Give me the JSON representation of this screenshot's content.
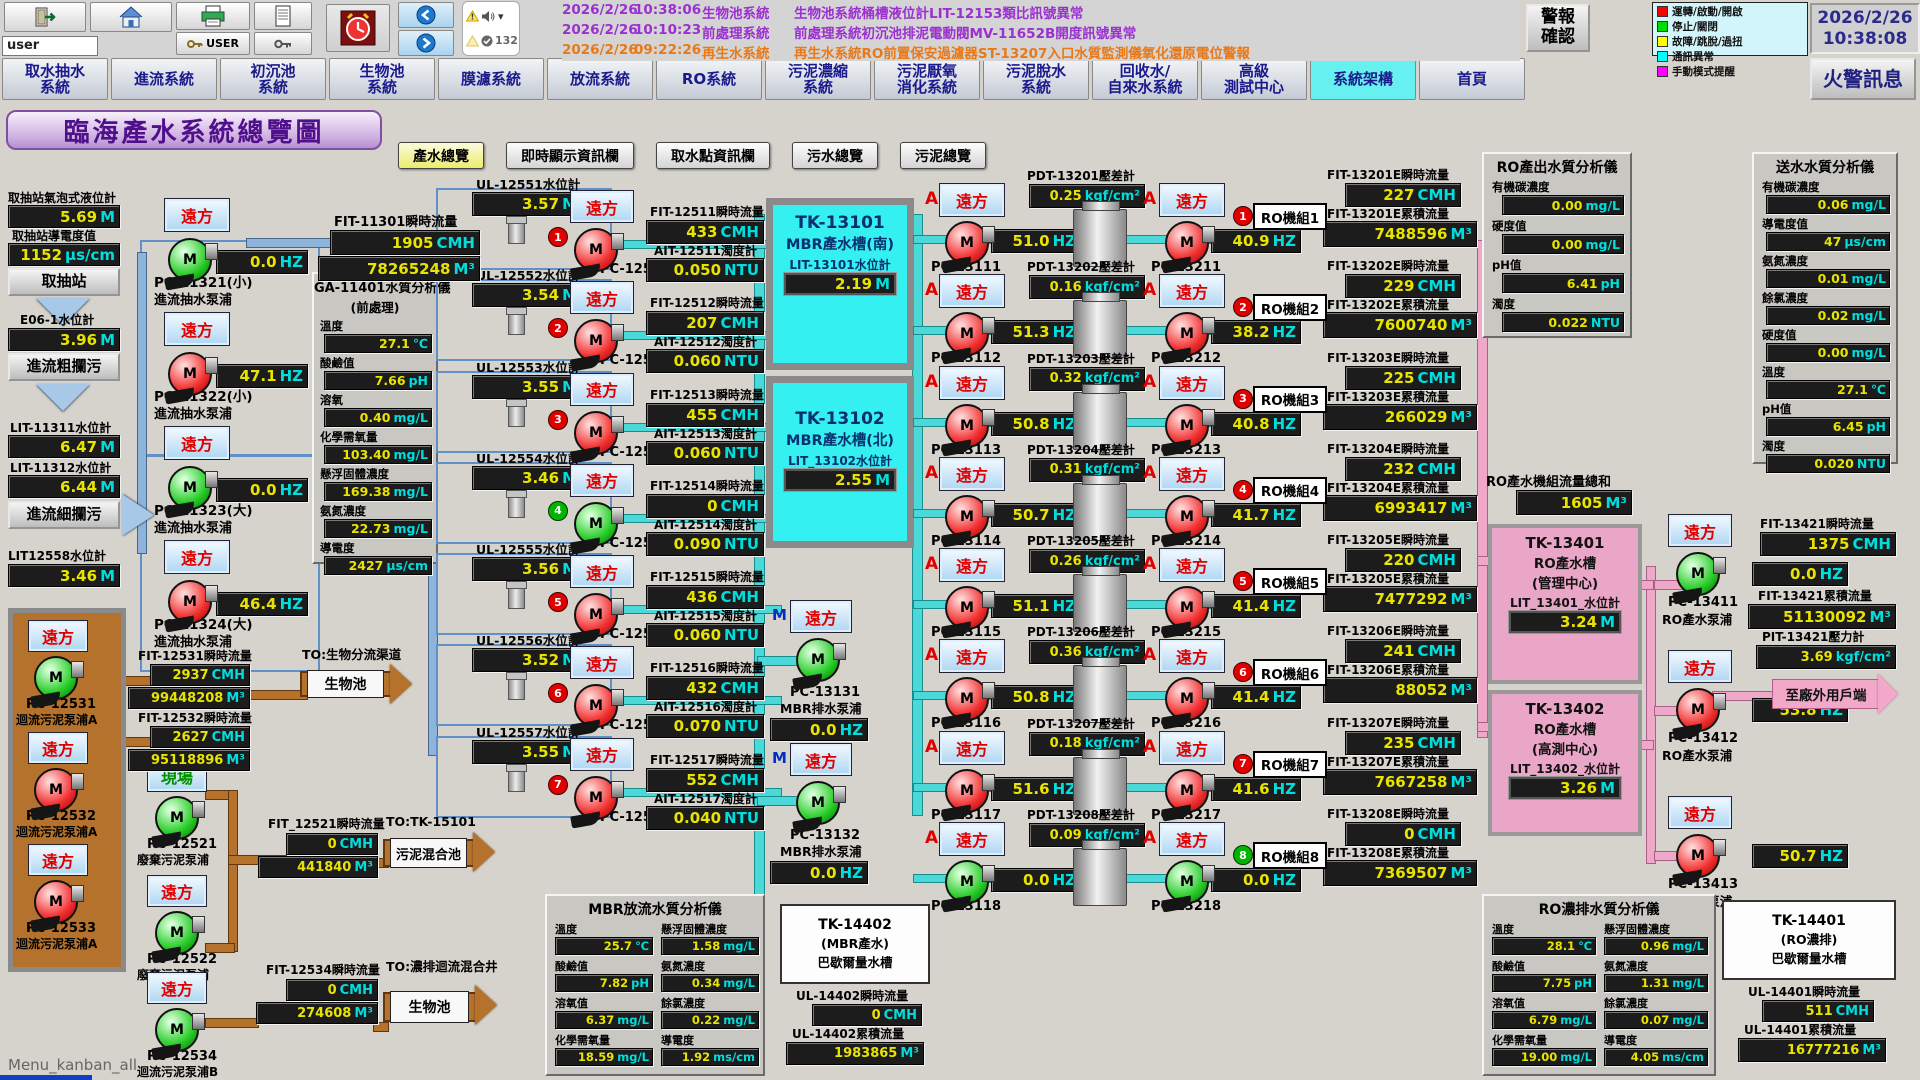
{
  "window": {
    "footer": "Menu_kanban_all"
  },
  "toolbar": {
    "user_value": "user",
    "user_button_label": "USER",
    "alarm_count": "132"
  },
  "alarm_list": [
    {
      "date": "2026/2/26",
      "time": "10:38:06",
      "system": "生物池系統",
      "message": "生物池系統桶槽液位計LIT-12153類比訊號異常",
      "severity": "warning"
    },
    {
      "date": "2026/2/26",
      "time": "10:10:23",
      "system": "前處理系統",
      "message": "前處理系統初沉池排泥電動閥MV-11652B開度訊號異常",
      "severity": "warning"
    },
    {
      "date": "2026/2/26",
      "time": "09:22:26",
      "system": "再生水系統",
      "message": "再生水系統RO前置保安過濾器ST-13207入口水質監測儀氧化還原電位警報",
      "severity": "alert"
    }
  ],
  "alarm_ack_label": "警報\n確認",
  "legend": {
    "items": [
      {
        "color": "#ff0000",
        "label": "運轉/啟動/開啟"
      },
      {
        "color": "#00dd00",
        "label": "停止/關閉"
      },
      {
        "color": "#ffff00",
        "label": "故障/跳脫/過扭"
      },
      {
        "color": "#00ffff",
        "label": "通訊異常"
      },
      {
        "color": "#ff00ff",
        "label": "手動模式提醒"
      }
    ]
  },
  "clock": {
    "date": "2026/2/26",
    "time": "10:38:08"
  },
  "fire_alarm_label": "火警訊息",
  "tabs": [
    {
      "label": "取水抽水\n系統",
      "active": "false"
    },
    {
      "label": "進流系統",
      "active": "false"
    },
    {
      "label": "初沉池\n系統",
      "active": "false"
    },
    {
      "label": "生物池\n系統",
      "active": "false"
    },
    {
      "label": "膜濾系統",
      "active": "false"
    },
    {
      "label": "放流系統",
      "active": "false"
    },
    {
      "label": "RO系統",
      "active": "false"
    },
    {
      "label": "污泥濃縮\n系統",
      "active": "false"
    },
    {
      "label": "污泥厭氧\n消化系統",
      "active": "false"
    },
    {
      "label": "污泥脫水\n系統",
      "active": "false"
    },
    {
      "label": "回收水/\n自來水系統",
      "active": "false"
    },
    {
      "label": "高級\n測試中心",
      "active": "false"
    },
    {
      "label": "系統架構",
      "active": "true"
    },
    {
      "label": "首頁",
      "active": "false"
    }
  ],
  "page_title": "臨海產水系統總覽圖",
  "view_buttons": [
    {
      "label": "產水總覽",
      "hl": "true"
    },
    {
      "label": "即時顯示資訊欄",
      "hl": "false"
    },
    {
      "label": "取水點資訊欄",
      "hl": "false"
    },
    {
      "label": "污水總覽",
      "hl": "false"
    },
    {
      "label": "污泥總覽",
      "hl": "false"
    }
  ],
  "intake": {
    "bubble_label": "取抽站氣泡式液位計",
    "bubble_value": "5.69",
    "bubble_unit": "M",
    "cond_label": "取抽站導電度值",
    "cond_value": "1152",
    "cond_unit": "μs/cm",
    "station_btn": "取抽站",
    "e06_label": "E06-1水位計",
    "e06_value": "3.96",
    "e06_unit": "M",
    "coarse_btn": "進流粗攔污",
    "lit11311_label": "LIT-11311水位計",
    "lit11311_value": "6.47",
    "lit11311_unit": "M",
    "lit11312_label": "LIT-11312水位計",
    "lit11312_value": "6.44",
    "lit11312_unit": "M",
    "fine_btn": "進流細攔污",
    "lit12558_label": "LIT12558水位計",
    "lit12558_value": "3.46",
    "lit12558_unit": "M"
  },
  "inflow_pumps": [
    {
      "btn": "遠方",
      "pm": "M",
      "state": "stop",
      "hz": "0.0",
      "hzu": "HZ",
      "name": "PC-11321(小)",
      "desc": "進流抽水泵浦"
    },
    {
      "btn": "遠方",
      "pm": "M",
      "state": "run",
      "hz": "47.1",
      "hzu": "HZ",
      "name": "PC-11322(小)",
      "desc": "進流抽水泵浦"
    },
    {
      "btn": "遠方",
      "pm": "M",
      "state": "stop",
      "hz": "0.0",
      "hzu": "HZ",
      "name": "PC-11323(大)",
      "desc": "進流抽水泵浦"
    },
    {
      "btn": "遠方",
      "pm": "M",
      "state": "run",
      "hz": "46.4",
      "hzu": "HZ",
      "name": "PC-11324(大)",
      "desc": "進流抽水泵浦"
    }
  ],
  "fit11301": {
    "flow_label": "FIT-11301瞬時流量",
    "flow_value": "1905",
    "flow_unit": "CMH",
    "total_value": "78265248",
    "total_unit": "M³"
  },
  "ga_panel": {
    "title": "GA-11401水質分析儀",
    "subtitle": "(前處理)",
    "fields": [
      {
        "label": "溫度",
        "value": "27.1",
        "unit": "℃"
      },
      {
        "label": "酸鹼值",
        "value": "7.66",
        "unit": "pH"
      },
      {
        "label": "溶氧",
        "value": "0.40",
        "unit": "mg/L"
      },
      {
        "label": "化學需氧量",
        "value": "103.40",
        "unit": "mg/L"
      },
      {
        "label": "懸浮固體濃度",
        "value": "169.38",
        "unit": "mg/L"
      },
      {
        "label": "氨氮濃度",
        "value": "22.73",
        "unit": "mg/L"
      },
      {
        "label": "導電度",
        "value": "2427",
        "unit": "μs/cm"
      }
    ]
  },
  "mbr_wells": [
    {
      "num": "1",
      "num_state": "run",
      "ul_label": "UL-12551水位計",
      "ul_value": "3.57",
      "ul_unit": "M",
      "btn": "遠方",
      "pm": "M",
      "state": "run",
      "name": "PC-12511",
      "fit_label": "FIT-12511瞬時流量",
      "fit_value": "433",
      "fit_unit": "CMH",
      "ait_label": "AIT-12511濁度計",
      "ait_value": "0.050",
      "ait_unit": "NTU"
    },
    {
      "num": "2",
      "num_state": "run",
      "ul_label": "UL-12552水位計",
      "ul_value": "3.54",
      "ul_unit": "M",
      "btn": "遠方",
      "pm": "M",
      "state": "run",
      "name": "PC-12512",
      "fit_label": "FIT-12512瞬時流量",
      "fit_value": "207",
      "fit_unit": "CMH",
      "ait_label": "AIT-12512濁度計",
      "ait_value": "0.060",
      "ait_unit": "NTU"
    },
    {
      "num": "3",
      "num_state": "run",
      "ul_label": "UL-12553水位計",
      "ul_value": "3.55",
      "ul_unit": "M",
      "btn": "遠方",
      "pm": "M",
      "state": "run",
      "name": "PC-12513",
      "fit_label": "FIT-12513瞬時流量",
      "fit_value": "455",
      "fit_unit": "CMH",
      "ait_label": "AIT-12513濁度計",
      "ait_value": "0.060",
      "ait_unit": "NTU"
    },
    {
      "num": "4",
      "num_state": "stop",
      "ul_label": "UL-12554水位計",
      "ul_value": "3.46",
      "ul_unit": "M",
      "btn": "遠方",
      "pm": "M",
      "state": "stop",
      "name": "PC-12514",
      "fit_label": "FIT-12514瞬時流量",
      "fit_value": "0",
      "fit_unit": "CMH",
      "ait_label": "AIT-12514濁度計",
      "ait_value": "0.090",
      "ait_unit": "NTU"
    },
    {
      "num": "5",
      "num_state": "run",
      "ul_label": "UL-12555水位計",
      "ul_value": "3.56",
      "ul_unit": "M",
      "btn": "遠方",
      "pm": "M",
      "state": "run",
      "name": "PC-12515",
      "fit_label": "FIT-12515瞬時流量",
      "fit_value": "436",
      "fit_unit": "CMH",
      "ait_label": "AIT-12515濁度計",
      "ait_value": "0.060",
      "ait_unit": "NTU"
    },
    {
      "num": "6",
      "num_state": "run",
      "ul_label": "UL-12556水位計",
      "ul_value": "3.52",
      "ul_unit": "M",
      "btn": "遠方",
      "pm": "M",
      "state": "run",
      "name": "PC-12516",
      "fit_label": "FIT-12516瞬時流量",
      "fit_value": "432",
      "fit_unit": "CMH",
      "ait_label": "AIT-12516濁度計",
      "ait_value": "0.070",
      "ait_unit": "NTU"
    },
    {
      "num": "7",
      "num_state": "run",
      "ul_label": "UL-12557水位計",
      "ul_value": "3.55",
      "ul_unit": "M",
      "btn": "遠方",
      "pm": "M",
      "state": "run",
      "name": "PC-12517",
      "fit_label": "FIT-12517瞬時流量",
      "fit_value": "552",
      "fit_unit": "CMH",
      "ait_label": "AIT-12517濁度計",
      "ait_value": "0.040",
      "ait_unit": "NTU"
    }
  ],
  "tanks": {
    "t1": {
      "name": "TK-13101",
      "desc": "MBR產水槽(南)",
      "lit_label": "LIT-13101水位計",
      "value": "2.19",
      "unit": "M"
    },
    "t2": {
      "name": "TK-13102",
      "desc": "MBR產水槽(北)",
      "lit_label": "LIT_13102水位計",
      "value": "2.55",
      "unit": "M"
    }
  },
  "drain_pumps": [
    {
      "m": "M",
      "btn": "遠方",
      "pm": "M",
      "state": "stop",
      "name": "PC-13131",
      "desc": "MBR排水泵浦",
      "hz": "0.0",
      "hzu": "HZ"
    },
    {
      "m": "M",
      "btn": "遠方",
      "pm": "M",
      "state": "stop",
      "name": "PC-13132",
      "desc": "MBR排水泵浦",
      "hz": "0.0",
      "hzu": "HZ"
    }
  ],
  "ro_rows": [
    {
      "a1": "A",
      "btn1": "遠方",
      "pm": "M",
      "state1": "run",
      "hz1": "51.0",
      "hzu": "HZ",
      "name1": "PC-13111",
      "pdt_label": "PDT-13201壓差計",
      "pdt_value": "0.25",
      "pdt_unit": "kgf/cm²",
      "a2": "A",
      "btn2": "遠方",
      "state2": "run",
      "hz2": "40.9",
      "name2": "PC-13211",
      "num": "1",
      "num_state": "run",
      "unit_name": "RO機組1",
      "fit_i_label": "FIT-13201E瞬時流量",
      "fit_i_value": "227",
      "fit_i_unit": "CMH",
      "fit_c_label": "FIT-13201E累積流量",
      "fit_c_value": "7488596",
      "fit_c_unit": "M³"
    },
    {
      "a1": "A",
      "btn1": "遠方",
      "pm": "M",
      "state1": "run",
      "hz1": "51.3",
      "hzu": "HZ",
      "name1": "PC-13112",
      "pdt_label": "PDT-13202壓差計",
      "pdt_value": "0.16",
      "pdt_unit": "kgf/cm²",
      "a2": "A",
      "btn2": "遠方",
      "state2": "run",
      "hz2": "38.2",
      "name2": "PC-13212",
      "num": "2",
      "num_state": "run",
      "unit_name": "RO機組2",
      "fit_i_label": "FIT-13202E瞬時流量",
      "fit_i_value": "229",
      "fit_i_unit": "CMH",
      "fit_c_label": "FIT-13202E累積流量",
      "fit_c_value": "7600740",
      "fit_c_unit": "M³"
    },
    {
      "a1": "A",
      "btn1": "遠方",
      "pm": "M",
      "state1": "run",
      "hz1": "50.8",
      "hzu": "HZ",
      "name1": "PC-13113",
      "pdt_label": "PDT-13203壓差計",
      "pdt_value": "0.32",
      "pdt_unit": "kgf/cm²",
      "a2": "A",
      "btn2": "遠方",
      "state2": "run",
      "hz2": "40.8",
      "name2": "PC-13213",
      "num": "3",
      "num_state": "run",
      "unit_name": "RO機組3",
      "fit_i_label": "FIT-13203E瞬時流量",
      "fit_i_value": "225",
      "fit_i_unit": "CMH",
      "fit_c_label": "FIT-13203E累積流量",
      "fit_c_value": "266029",
      "fit_c_unit": "M³"
    },
    {
      "a1": "A",
      "btn1": "遠方",
      "pm": "M",
      "state1": "run",
      "hz1": "50.7",
      "hzu": "HZ",
      "name1": "PC-13114",
      "pdt_label": "PDT-13204壓差計",
      "pdt_value": "0.31",
      "pdt_unit": "kgf/cm²",
      "a2": "A",
      "btn2": "遠方",
      "state2": "run",
      "hz2": "41.7",
      "name2": "PC-13214",
      "num": "4",
      "num_state": "run",
      "unit_name": "RO機組4",
      "fit_i_label": "FIT-13204E瞬時流量",
      "fit_i_value": "232",
      "fit_i_unit": "CMH",
      "fit_c_label": "FIT-13204E累積流量",
      "fit_c_value": "6993417",
      "fit_c_unit": "M³"
    },
    {
      "a1": "A",
      "btn1": "遠方",
      "pm": "M",
      "state1": "run",
      "hz1": "51.1",
      "hzu": "HZ",
      "name1": "PC-13115",
      "pdt_label": "PDT-13205壓差計",
      "pdt_value": "0.26",
      "pdt_unit": "kgf/cm²",
      "a2": "A",
      "btn2": "遠方",
      "state2": "run",
      "hz2": "41.4",
      "name2": "PC-13215",
      "num": "5",
      "num_state": "run",
      "unit_name": "RO機組5",
      "fit_i_label": "FIT-13205E瞬時流量",
      "fit_i_value": "220",
      "fit_i_unit": "CMH",
      "fit_c_label": "FIT-13205E累積流量",
      "fit_c_value": "7477292",
      "fit_c_unit": "M³"
    },
    {
      "a1": "A",
      "btn1": "遠方",
      "pm": "M",
      "state1": "run",
      "hz1": "50.8",
      "hzu": "HZ",
      "name1": "PC-13116",
      "pdt_label": "PDT-13206壓差計",
      "pdt_value": "0.36",
      "pdt_unit": "kgf/cm²",
      "a2": "A",
      "btn2": "遠方",
      "state2": "run",
      "hz2": "41.4",
      "name2": "PC-13216",
      "num": "6",
      "num_state": "run",
      "unit_name": "RO機組6",
      "fit_i_label": "FIT-13206E瞬時流量",
      "fit_i_value": "241",
      "fit_i_unit": "CMH",
      "fit_c_label": "FIT-13206E累積流量",
      "fit_c_value": "88052",
      "fit_c_unit": "M³"
    },
    {
      "a1": "A",
      "btn1": "遠方",
      "pm": "M",
      "state1": "run",
      "hz1": "51.6",
      "hzu": "HZ",
      "name1": "PC-13117",
      "pdt_label": "PDT-13207壓差計",
      "pdt_value": "0.18",
      "pdt_unit": "kgf/cm²",
      "a2": "A",
      "btn2": "遠方",
      "state2": "run",
      "hz2": "41.6",
      "name2": "PC-13217",
      "num": "7",
      "num_state": "run",
      "unit_name": "RO機組7",
      "fit_i_label": "FIT-13207E瞬時流量",
      "fit_i_value": "235",
      "fit_i_unit": "CMH",
      "fit_c_label": "FIT-13207E累積流量",
      "fit_c_value": "7667258",
      "fit_c_unit": "M³"
    },
    {
      "a1": "A",
      "btn1": "遠方",
      "pm": "M",
      "state1": "stop",
      "hz1": "0.0",
      "hzu": "HZ",
      "name1": "PC-13118",
      "pdt_label": "PDT-13208壓差計",
      "pdt_value": "0.09",
      "pdt_unit": "kgf/cm²",
      "a2": "A",
      "btn2": "遠方",
      "state2": "stop",
      "hz2": "0.0",
      "name2": "PC-13218",
      "num": "8",
      "num_state": "stop",
      "unit_name": "RO機組8",
      "fit_i_label": "FIT-13208E瞬時流量",
      "fit_i_value": "0",
      "fit_i_unit": "CMH",
      "fit_c_label": "FIT-13208E累積流量",
      "fit_c_value": "7369507",
      "fit_c_unit": "M³"
    }
  ],
  "ro_total": {
    "label": "RO產水機組流量總和",
    "value": "1605",
    "unit": "M³"
  },
  "ro_out_panel": {
    "title": "RO產出水質分析儀",
    "fields": [
      {
        "label": "有機碳濃度",
        "value": "0.00",
        "unit": "mg/L"
      },
      {
        "label": "硬度值",
        "value": "0.00",
        "unit": "mg/L"
      },
      {
        "label": "pH值",
        "value": "6.41",
        "unit": "pH"
      },
      {
        "label": "濁度",
        "value": "0.022",
        "unit": "NTU"
      }
    ]
  },
  "send_panel": {
    "title": "送水水質分析儀",
    "fields": [
      {
        "label": "有機碳濃度",
        "value": "0.06",
        "unit": "mg/L"
      },
      {
        "label": "導電度值",
        "value": "47",
        "unit": "μs/cm"
      },
      {
        "label": "氨氮濃度",
        "value": "0.01",
        "unit": "mg/L"
      },
      {
        "label": "餘氯濃度",
        "value": "0.02",
        "unit": "mg/L"
      },
      {
        "label": "硬度值",
        "value": "0.00",
        "unit": "mg/L"
      },
      {
        "label": "溫度",
        "value": "27.1",
        "unit": "℃"
      },
      {
        "label": "pH值",
        "value": "6.45",
        "unit": "pH"
      },
      {
        "label": "濁度",
        "value": "0.020",
        "unit": "NTU"
      }
    ]
  },
  "ro_tanks": {
    "t1": {
      "name": "TK-13401",
      "line2": "RO產水槽",
      "line3": "(管理中心)",
      "lit_label": "LIT_13401_水位計",
      "value": "3.24",
      "unit": "M"
    },
    "t2": {
      "name": "TK-13402",
      "line2": "RO產水槽",
      "line3": "(高測中心)",
      "lit_label": "LIT_13402_水位計",
      "value": "3.26",
      "unit": "M"
    }
  },
  "ro_pumps": [
    {
      "btn": "遠方",
      "pm": "M",
      "state": "stop",
      "name": "PC-13411",
      "desc": "RO產水泵浦",
      "hz": "0.0",
      "hzu": "HZ"
    },
    {
      "btn": "遠方",
      "pm": "M",
      "state": "run",
      "name": "PC-13412",
      "desc": "RO產水泵浦",
      "hz": "53.8",
      "hzu": "HZ"
    },
    {
      "btn": "遠方",
      "pm": "M",
      "state": "run",
      "name": "PC-13413",
      "desc": "RO產水泵浦",
      "hz": "50.7",
      "hzu": "HZ"
    }
  ],
  "fit13421": {
    "i_label": "FIT-13421瞬時流量",
    "i_value": "1375",
    "i_unit": "CMH",
    "c_label": "FIT-13421累積流量",
    "c_value": "51130092",
    "c_unit": "M³",
    "p_label": "PIT-13421壓力計",
    "p_value": "3.69",
    "p_unit": "kgf/cm²"
  },
  "external_arrow": "至廠外用戶端",
  "sludge_pumps": [
    {
      "btn": "遠方",
      "pm": "M",
      "state": "stop",
      "name": "PC-12531",
      "desc": "迴流污泥泵浦A"
    },
    {
      "btn": "遠方",
      "pm": "M",
      "state": "run",
      "name": "PC-12532",
      "desc": "迴流污泥泵浦A"
    },
    {
      "btn": "遠方",
      "pm": "M",
      "state": "run",
      "name": "PC-12533",
      "desc": "迴流污泥泵浦A"
    }
  ],
  "fit12531": {
    "label": "FIT-12531瞬時流量",
    "value": "2937",
    "unit": "CMH",
    "total": "99448208",
    "total_unit": "M³"
  },
  "fit12532": {
    "label": "FIT-12532瞬時流量",
    "value": "2627",
    "unit": "CMH",
    "total": "95118896",
    "total_unit": "M³"
  },
  "bio_arrow1": {
    "to": "TO:生物分流渠道",
    "label": "生物池"
  },
  "waste_pumps": [
    {
      "btn": "現場",
      "kind": "local",
      "pm": "M",
      "state": "stop",
      "name": "PC-12521",
      "desc": "廢棄污泥泵浦"
    },
    {
      "btn": "遠方",
      "kind": "remote",
      "pm": "M",
      "state": "stop",
      "name": "PC-12522",
      "desc": "廢棄污泥泵浦"
    }
  ],
  "fit12521": {
    "label": "FIT_12521瞬時流量",
    "value": "0",
    "unit": "CMH",
    "total": "441840",
    "total_unit": "M³"
  },
  "mix_arrow": {
    "to": "TO:TK-15101",
    "label": "污泥混合池"
  },
  "pc12534": {
    "btn": "遠方",
    "kind": "remote",
    "pm": "M",
    "state": "stop",
    "name": "PC-12534",
    "desc": "迴流污泥泵浦B"
  },
  "fit12534": {
    "label": "FIT-12534瞬時流量",
    "value": "0",
    "unit": "CMH",
    "total": "274608",
    "total_unit": "M³"
  },
  "bio_arrow2": {
    "to": "TO:濃排迴流混合井",
    "label": "生物池"
  },
  "mbr_panel": {
    "title": "MBR放流水質分析儀",
    "fields": [
      {
        "label": "溫度",
        "value": "25.7",
        "unit": "℃"
      },
      {
        "label": "懸浮固體濃度",
        "value": "1.58",
        "unit": "mg/L"
      },
      {
        "label": "酸鹼值",
        "value": "7.82",
        "unit": "pH"
      },
      {
        "label": "氨氮濃度",
        "value": "0.34",
        "unit": "mg/L"
      },
      {
        "label": "溶氧值",
        "value": "6.37",
        "unit": "mg/L"
      },
      {
        "label": "餘氯濃度",
        "value": "0.22",
        "unit": "mg/L"
      },
      {
        "label": "化學需氧量",
        "value": "18.59",
        "unit": "mg/L"
      },
      {
        "label": "導電度",
        "value": "1.92",
        "unit": "ms/cm"
      }
    ]
  },
  "tk14402": {
    "name": "TK-14402",
    "line2": "(MBR產水)",
    "line3": "巴歇爾量水槽",
    "i_label": "UL-14402瞬時流量",
    "i_value": "0",
    "i_unit": "CMH",
    "c_label": "UL-14402累積流量",
    "c_value": "1983865",
    "c_unit": "M³"
  },
  "conc_panel": {
    "title": "RO濃排水質分析儀",
    "fields": [
      {
        "label": "溫度",
        "value": "28.1",
        "unit": "℃"
      },
      {
        "label": "懸浮固體濃度",
        "value": "0.96",
        "unit": "mg/L"
      },
      {
        "label": "酸鹼值",
        "value": "7.75",
        "unit": "pH"
      },
      {
        "label": "氨氮濃度",
        "value": "1.31",
        "unit": "mg/L"
      },
      {
        "label": "溶氧值",
        "value": "6.79",
        "unit": "mg/L"
      },
      {
        "label": "餘氯濃度",
        "value": "0.07",
        "unit": "mg/L"
      },
      {
        "label": "化學需氧量",
        "value": "19.00",
        "unit": "mg/L"
      },
      {
        "label": "導電度",
        "value": "4.05",
        "unit": "ms/cm"
      }
    ]
  },
  "tk14401": {
    "name": "TK-14401",
    "line2": "(RO濃排)",
    "line3": "巴歇爾量水槽",
    "i_label": "UL-14401瞬時流量",
    "i_value": "511",
    "i_unit": "CMH",
    "c_label": "UL-14401累積流量",
    "c_value": "16777216",
    "c_unit": "M³"
  }
}
